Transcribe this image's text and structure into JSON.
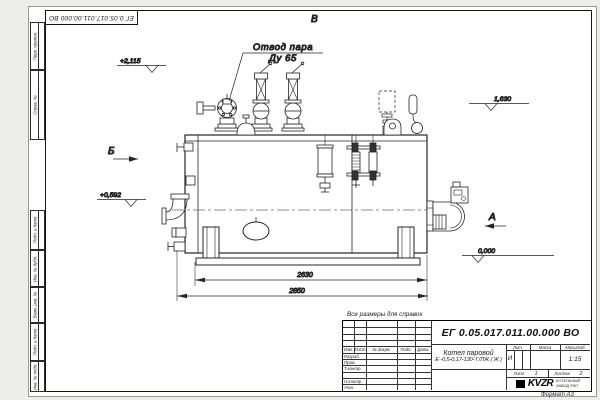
{
  "frame": {
    "top_doc_number": "ЕГ 0.05.017.011.00.000  ВО",
    "format_note": "Формат А3",
    "margin_stamps": [
      "Перв. примен.",
      "Справ. №",
      "Подп. и дата",
      "Инв. № дубл.",
      "Взам. инв. №",
      "Подп. и дата",
      "Инв. № подл."
    ]
  },
  "drawing": {
    "callout": {
      "line1": "Отвод пара",
      "line2": "Ду 65"
    },
    "view_markers": {
      "top": "В",
      "left": "Б",
      "right": "А"
    },
    "elevations": {
      "valve_top": "+2,115",
      "front_axis": "+0,592",
      "rear_top": "1,630",
      "ground": "0,000"
    },
    "dimensions": {
      "inner_length": "2630",
      "overall_length": "2850"
    }
  },
  "note": "Все размеры для справок",
  "title_block": {
    "doc_number": "ЕГ 0.05.017.011.00.000  ВО",
    "product_name_line1": "Котел паровой",
    "product_name_line2": "Е -0,5-0,17-130- Г/ЛЖ ( Ж )",
    "columns": {
      "izm": "Изм.",
      "list": "Лист",
      "doc": "№ докум.",
      "sign": "Подп.",
      "date": "Дата"
    },
    "roles": [
      "Разраб.",
      "Пров.",
      "Т.контр.",
      "",
      "Н.контр.",
      "Утв."
    ],
    "liter_header": "Лит.",
    "mass_header": "Масса",
    "scale_header": "Масштаб",
    "liter_value": "И",
    "scale_value": "1:15",
    "sheet_label": "Лист",
    "sheet_value": "1",
    "sheets_label": "Листов",
    "sheets_value": "2",
    "logo_text": "KVZR",
    "company_line1": "КОТЕЛЬНЫЙ",
    "company_line2": "ЗАВОД РЭП"
  }
}
